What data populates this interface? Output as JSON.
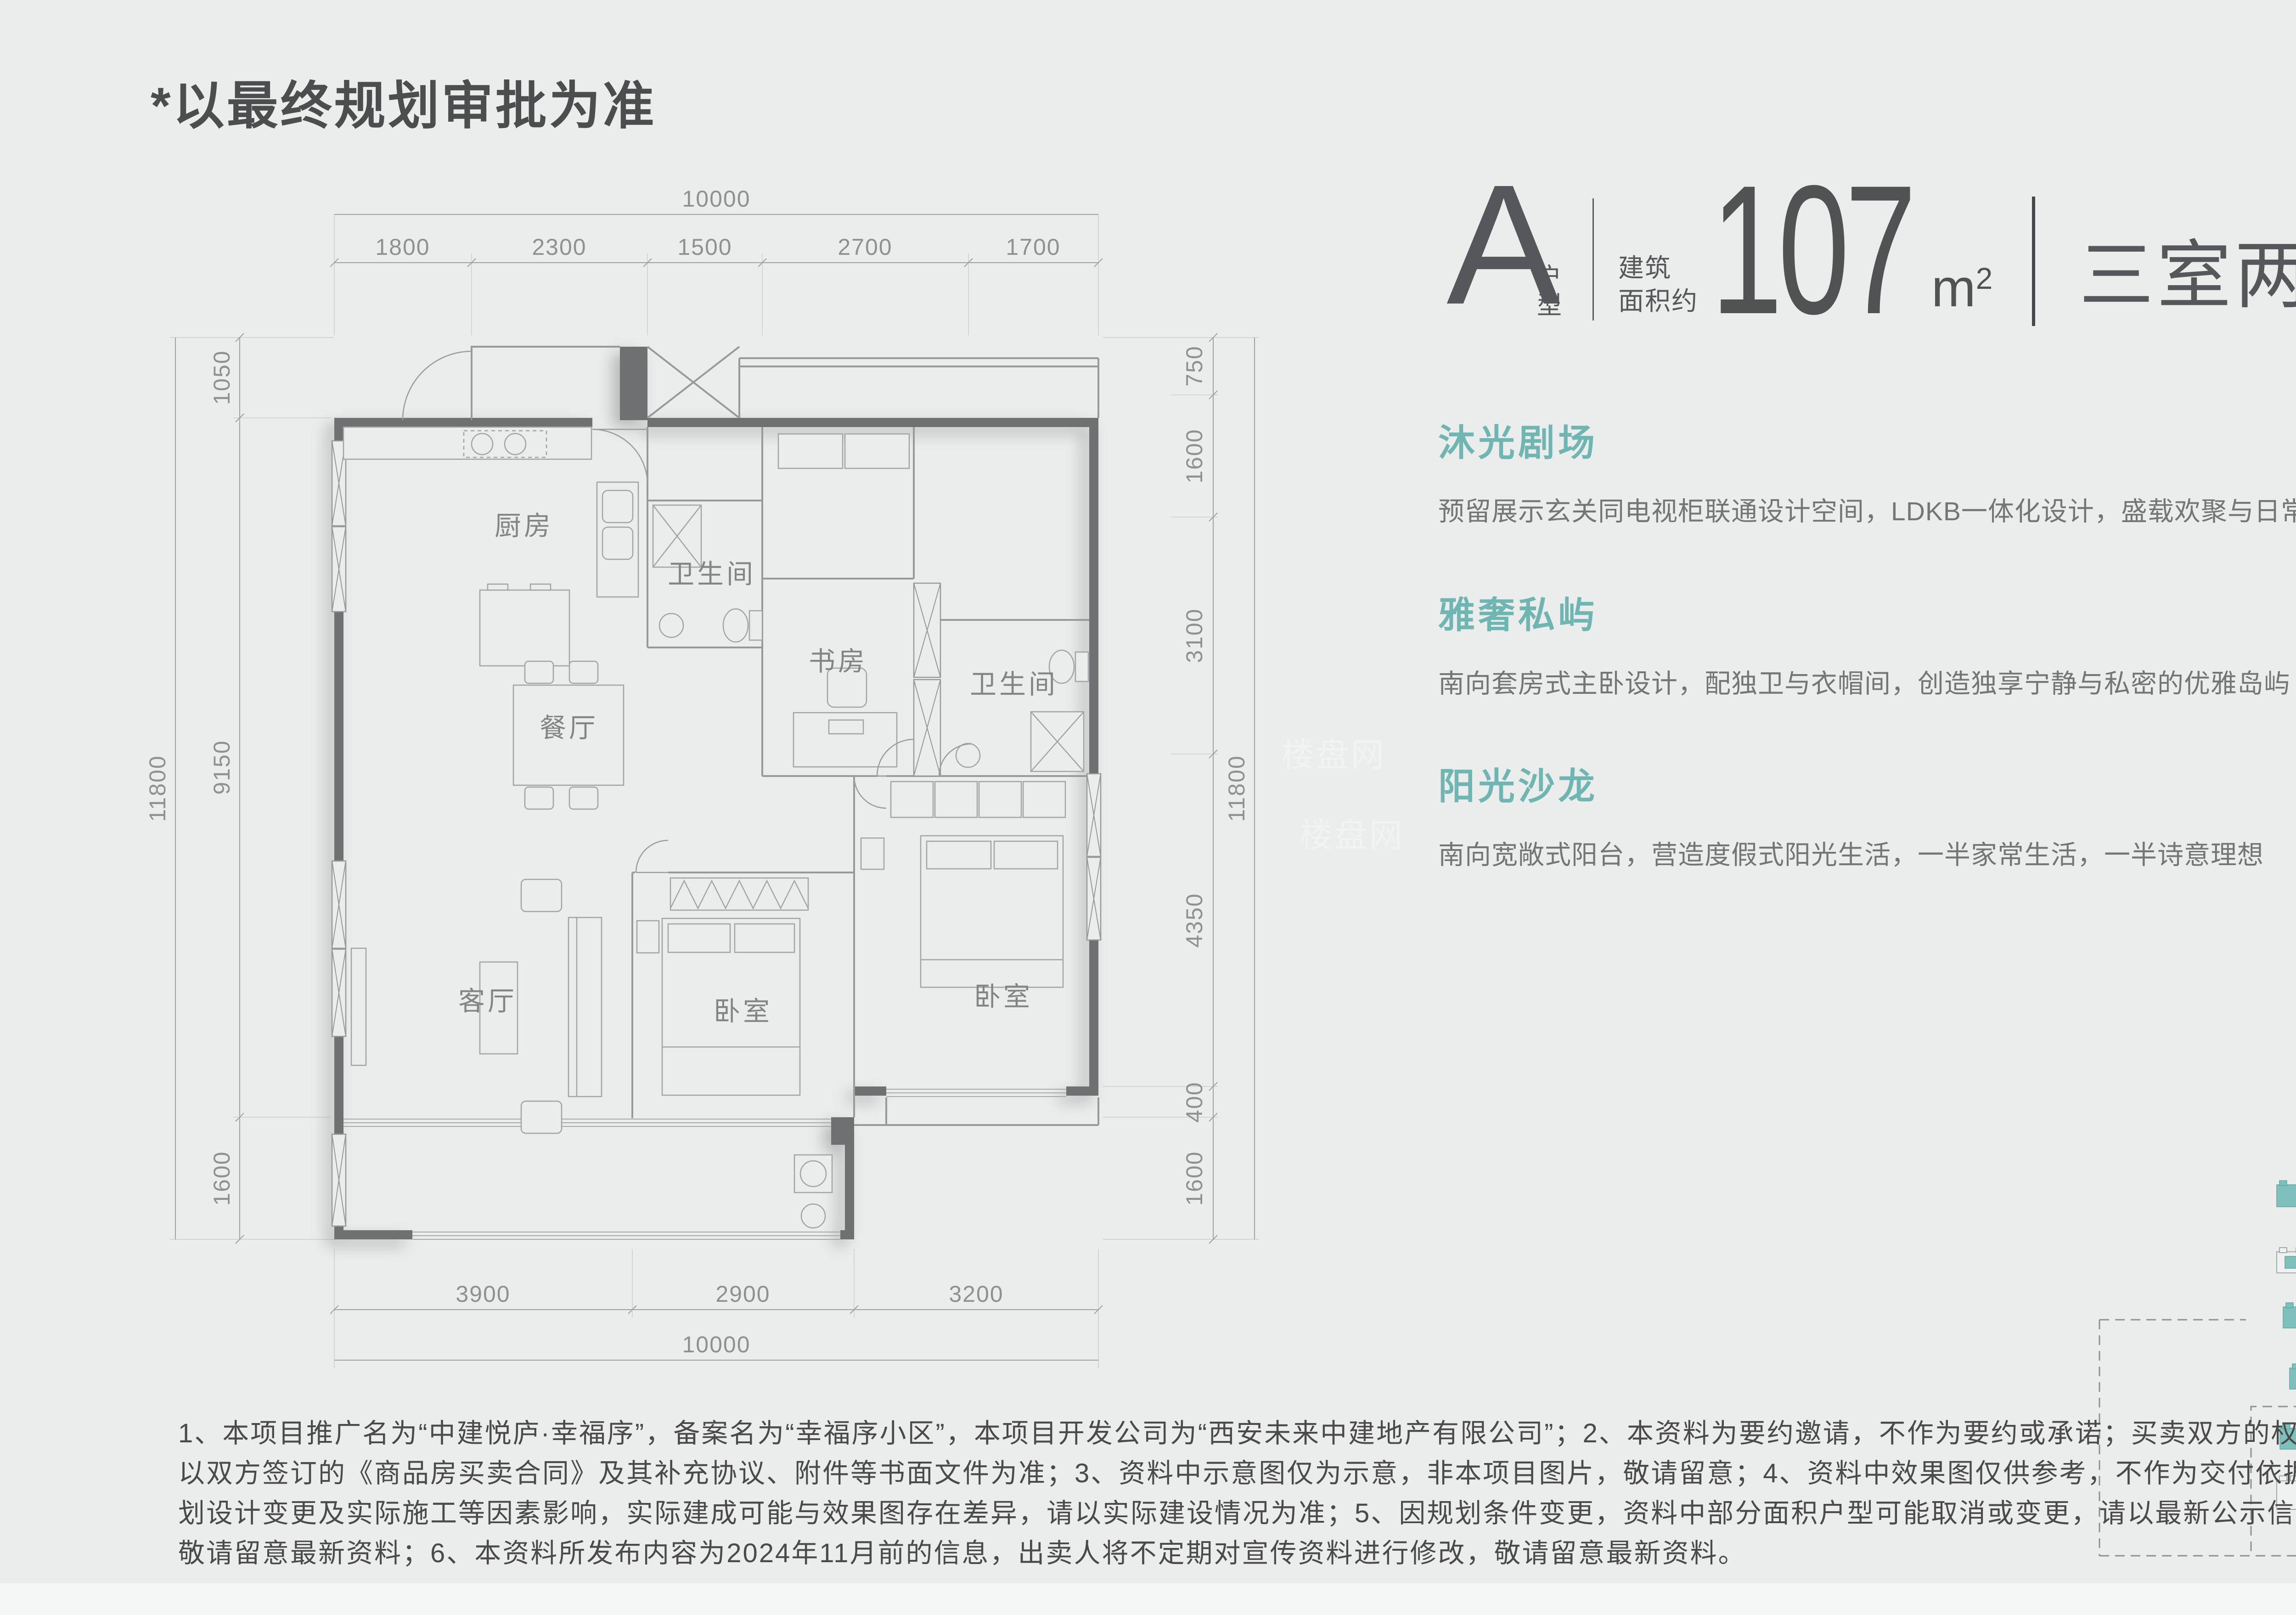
{
  "page": {
    "note": "*以最终规划审批为准",
    "watermark": "楼盘网",
    "colors": {
      "bg": "#EBECEC",
      "teal": "#6FB5B2",
      "wall": "#6E7071",
      "text_dark": "#55575A"
    }
  },
  "header": {
    "type_letter": "A",
    "type_label": "户型",
    "area_label_line1": "建筑",
    "area_label_line2": "面积约",
    "area_value": "107",
    "area_unit": "m",
    "area_unit_sup": "2",
    "layout_desc": "三室两厅两卫"
  },
  "features": [
    {
      "title": "沐光剧场",
      "desc": "预留展示玄关同电视柜联通设计空间，LDKB一体化设计，盛载欢聚与日常的情感交互中心"
    },
    {
      "title": "雅奢私屿",
      "desc": "南向套房式主卧设计，配独卫与衣帽间，创造独享宁静与私密的优雅岛屿"
    },
    {
      "title": "阳光沙龙",
      "desc": "南向宽敞式阳台，营造度假式阳光生活，一半家常生活，一半诗意理想"
    }
  ],
  "floorplan": {
    "rooms": {
      "kitchen": "厨房",
      "bath1": "卫生间",
      "study": "书房",
      "bath2": "卫生间",
      "dining": "餐厅",
      "living": "客厅",
      "bedroom1": "卧室",
      "bedroom2": "卧室"
    },
    "dims": {
      "top_total": "10000",
      "top": [
        "1800",
        "2300",
        "1500",
        "2700",
        "1700"
      ],
      "bottom": [
        "3900",
        "2900",
        "3200"
      ],
      "bottom_total": "10000",
      "left_total": "11800",
      "left": [
        "1050",
        "9150",
        "1600"
      ],
      "right": [
        "750",
        "1600",
        "3100",
        "4350",
        "400",
        "1600"
      ],
      "right_total": "11800"
    }
  },
  "disclaimer": {
    "line1": "1、本项目推广名为“中建悦庐·幸福序”，备案名为“幸福序小区”，本项目开发公司为“西安未来中建地产有限公司”；2、本资料为要约邀请，不作为要约或承诺；买卖双方的权利义务",
    "line2": "以双方签订的《商品房买卖合同》及其补充协议、附件等书面文件为准；3、资料中示意图仅为示意，非本项目图片，敬请留意；4、资料中效果图仅供参考，不作为交付依据，因规",
    "line3": "划设计变更及实际施工等因素影响，实际建成可能与效果图存在差异，请以实际建设情况为准；5、因规划条件变更，资料中部分面积户型可能取消或变更，请以最新公示信息为准，",
    "line4": "敬请留意最新资料；6、本资料所发布内容为2024年11月前的信息，出卖人将不定期对宣传资料进行修改，敬请留意最新资料。"
  }
}
